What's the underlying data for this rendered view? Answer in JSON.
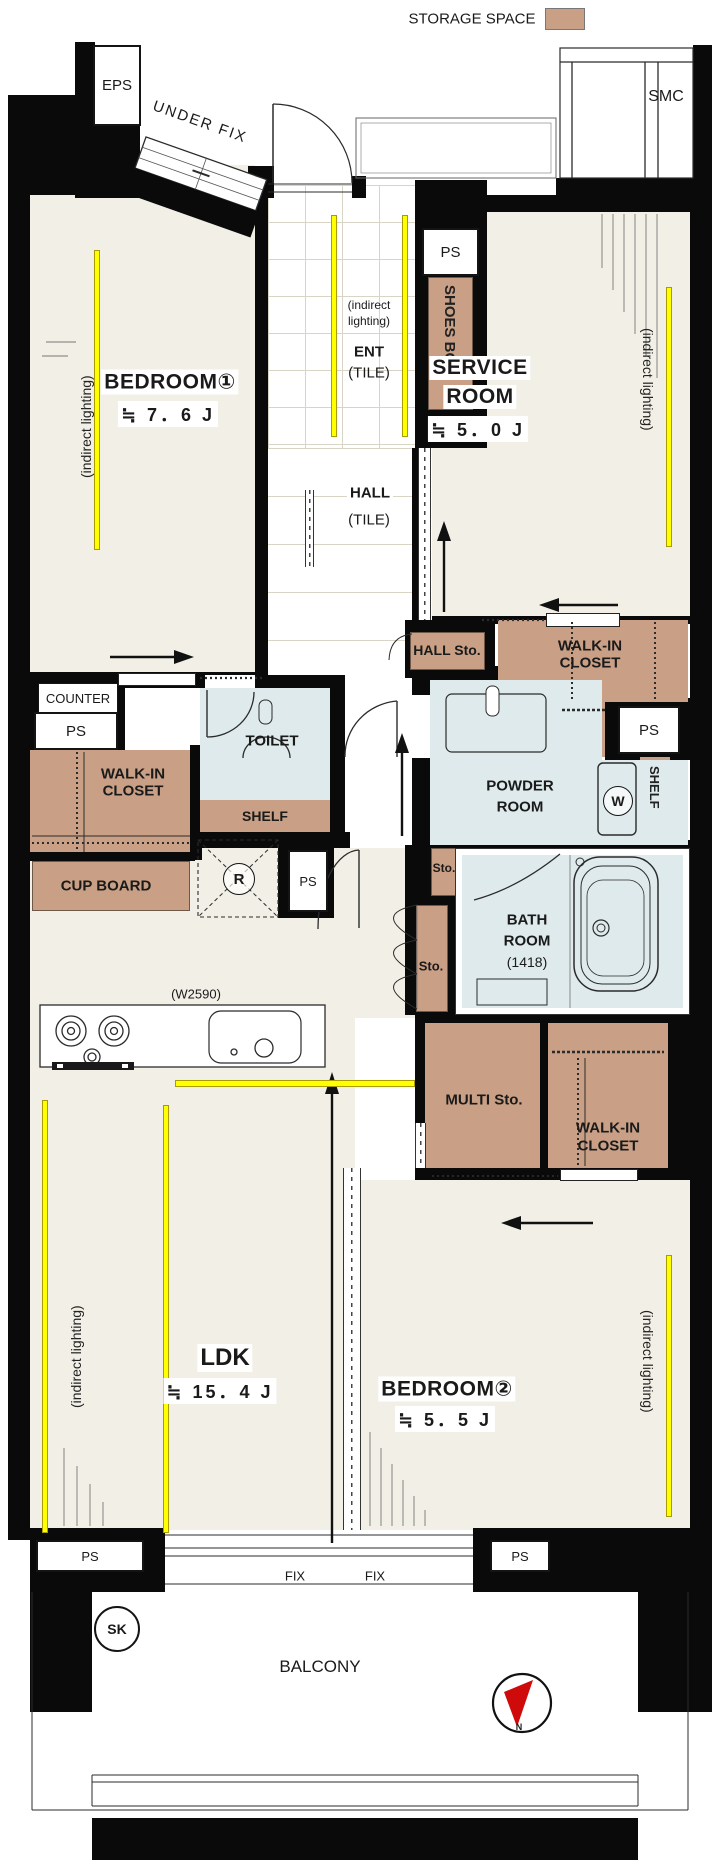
{
  "legend": {
    "storage_space": "STORAGE SPACE"
  },
  "colors": {
    "storage_fill": "#c9a086",
    "wet_area_fill": "#dfeaec",
    "room_fill": "#f2efe6",
    "indirect_lighting": "#ffff00",
    "compass_needle": "#cf0a0a"
  },
  "rooms": {
    "bedroom1": {
      "name": "BEDROOM①",
      "size": "≒ 7．6 J"
    },
    "service_room": {
      "name_line1": "SERVICE",
      "name_line2": "ROOM",
      "size": "≒ 5．0 J"
    },
    "ldk": {
      "name": "LDK",
      "size": "≒ 15．4 J"
    },
    "bedroom2": {
      "name": "BEDROOM②",
      "size": "≒ 5．5 J"
    },
    "ent": {
      "name": "ENT",
      "floor": "(TILE)"
    },
    "hall": {
      "name": "HALL",
      "floor": "(TILE)"
    },
    "toilet": {
      "name": "TOILET"
    },
    "powder_room": {
      "name_line1": "POWDER",
      "name_line2": "ROOM"
    },
    "bath_room": {
      "name_line1": "BATH",
      "name_line2": "ROOM",
      "size": "(1418)"
    },
    "balcony": {
      "name": "BALCONY"
    }
  },
  "storage": {
    "shoes_box": "SHOES BOX",
    "hall_storage": "HALL Sto.",
    "walk_in_closet_line1": "WALK-IN",
    "walk_in_closet_line2": "CLOSET",
    "counter": "COUNTER",
    "shelf": "SHELF",
    "cup_board": "CUP BOARD",
    "storage_abbrev": "Sto.",
    "multi_storage": "MULTI Sto."
  },
  "shafts": {
    "eps": "EPS",
    "smc": "SMC",
    "ps": "PS",
    "sk": "SK"
  },
  "fixtures": {
    "washing_machine": "W",
    "refrigerator": "R",
    "compass_north": "N"
  },
  "annotations": {
    "under_fix": "UNDER FIX",
    "indirect_lighting": "(indirect lighting)",
    "indirect_lighting_line1": "(indirect",
    "indirect_lighting_line2": "lighting)",
    "kitchen_width": "(W2590)",
    "fixed_window": "FIX"
  }
}
